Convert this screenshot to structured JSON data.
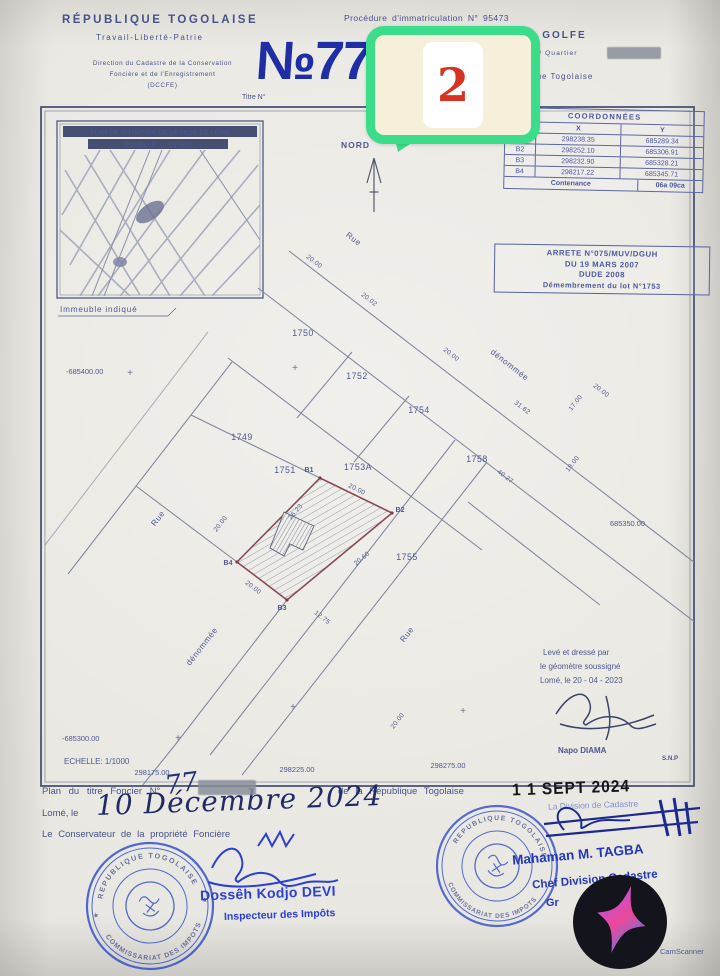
{
  "colors": {
    "ink_blue": "#1f2da6",
    "print_blue": "#46528a",
    "parcel_outline_maroon": "#7a3a48",
    "badge_green": "#3bdc8a",
    "badge_cream": "#f6f0da",
    "badge_red": "#d83222",
    "stamp_blue": "#2e4cc8",
    "date_stamp_black": "#17171a"
  },
  "header": {
    "republic": "RÉPUBLIQUE TOGOLAISE",
    "motto": "Travail-Liberté-Patrie",
    "direction_line1": "Direction du Cadastre de la Conservation",
    "direction_line2": "Foncière et de l'Enregistrement",
    "direction_line3": "(DCCFE)",
    "titre_label": "Titre N°",
    "titre_number": "№77",
    "procedure": "Procédure d'immatriculation N° 95473",
    "prefecture": "Préfecture GOLFE",
    "commune": "Commune / Quartier",
    "republic_small": "République Togolaise"
  },
  "badge": {
    "number": "2"
  },
  "north": {
    "label": "NORD"
  },
  "map_inset": {
    "title": "PLAN DE SITUATION DE LA VILLE DE LOME",
    "scale": "ECHELLE 1 : 15 000",
    "caption": "Immeuble indiqué"
  },
  "coord_table": {
    "title": "COORDONNÉES",
    "col_pts": "PTS",
    "col_x": "X",
    "col_y": "Y",
    "rows": [
      {
        "pt": "B1",
        "x": "298238.35",
        "y": "685289.34"
      },
      {
        "pt": "B2",
        "x": "298252.10",
        "y": "685306.91"
      },
      {
        "pt": "B3",
        "x": "298232.90",
        "y": "685328.21"
      },
      {
        "pt": "B4",
        "x": "298217.22",
        "y": "685345.71"
      }
    ],
    "footer_label": "Contenance",
    "footer_value": "06a 09ca"
  },
  "arrete": {
    "line1": "ARRETE N°075/MUV/DGUH",
    "line2": "DU 19 MARS 2007",
    "line3": "DUDE 2008",
    "line4": "Démembrement du lot N°1753"
  },
  "plan": {
    "parcels": [
      {
        "label": "1750"
      },
      {
        "label": "1752"
      },
      {
        "label": "1754"
      },
      {
        "label": "1749"
      },
      {
        "label": "1751"
      },
      {
        "label": "1753A"
      },
      {
        "label": "1758"
      },
      {
        "label": "1755"
      }
    ],
    "corners": [
      {
        "label": "B1"
      },
      {
        "label": "B2"
      },
      {
        "label": "B3"
      },
      {
        "label": "B4"
      }
    ],
    "dims": [
      {
        "t": "20.00"
      },
      {
        "t": "20.02"
      },
      {
        "t": "20.00"
      },
      {
        "t": "20.00"
      },
      {
        "t": "31.62"
      },
      {
        "t": "17.00"
      },
      {
        "t": "18.00"
      },
      {
        "t": "40.27"
      },
      {
        "t": "20.00"
      },
      {
        "t": "26.23"
      },
      {
        "t": "20.60"
      },
      {
        "t": "20.00"
      },
      {
        "t": "12.75"
      },
      {
        "t": "20.00"
      },
      {
        "t": "20.00"
      }
    ],
    "streets": [
      {
        "t": "Rue"
      },
      {
        "t": "dénommée"
      },
      {
        "t": "Rue"
      },
      {
        "t": "dénommée"
      },
      {
        "t": "Rue"
      }
    ],
    "grid": [
      {
        "t": "-685400.00"
      },
      {
        "t": "685350.00"
      },
      {
        "t": "-685300.00"
      },
      {
        "t": "298175.00"
      },
      {
        "t": "298225.00"
      },
      {
        "t": "298275.00"
      }
    ],
    "scale": "ECHELLE: 1/1000",
    "surveyor": {
      "l1": "Levé et dressé par",
      "l2": "le géomètre soussigné",
      "l3": "Lomé, le 20 - 04 - 2023",
      "name": "Napo DIAMA",
      "ref": "S.N.P"
    }
  },
  "footer": {
    "line1_pre": "Plan du titre Foncier N°",
    "line1_hand": "77",
    "line1_post": "de la République Togolaise",
    "line2_pre": "Lomé, le",
    "line2_hand": "10 Décembre 2024",
    "line3": "Le Conservateur de la propriété Foncière",
    "left_stamp_top": "REPUBLIQUE TOGOLAISE",
    "left_stamp_bottom": "COMMISSARIAT DES IMPOTS",
    "left_name": "Dossêh Kodjo DEVI",
    "left_role": "Inspecteur des Impôts",
    "date_stamp": "1 1 SEPT 2024",
    "division": "La Division de Cadastre",
    "right_stamp_top": "REPUBLIQUE TOGOLAISE",
    "right_stamp_bottom": "COMMISSARIAT DES IMPOTS",
    "right_name": "Mahaman M. TAGBA",
    "right_role": "Chef Division Cadastre",
    "right_extra": "Gr"
  },
  "scanner": {
    "brand": "CamScanner"
  }
}
